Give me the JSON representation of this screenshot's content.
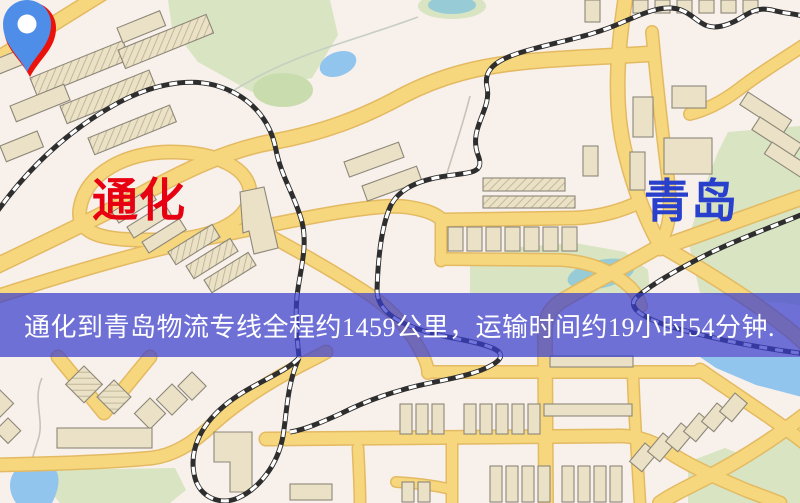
{
  "banner": {
    "text": "通化到青岛物流专线全程约1459公里，运输时间约19小时54分钟.",
    "bg_color": "rgba(58,62,205,0.72)",
    "text_color": "#ffffff"
  },
  "origin": {
    "label": "通化",
    "label_color": "#e60012",
    "pin_color": "#ea120b"
  },
  "destination": {
    "label": "青岛",
    "label_color": "#2840cc",
    "pin_color": "#4e8ee9"
  },
  "map_palette": {
    "land": "#f8f0ea",
    "road": "#f7d77d",
    "road_casing": "#e3ba62",
    "park": "#d8e4c2",
    "water": "#92c5ee",
    "railway": "#2e2e2e",
    "building": "#eae1c6"
  }
}
